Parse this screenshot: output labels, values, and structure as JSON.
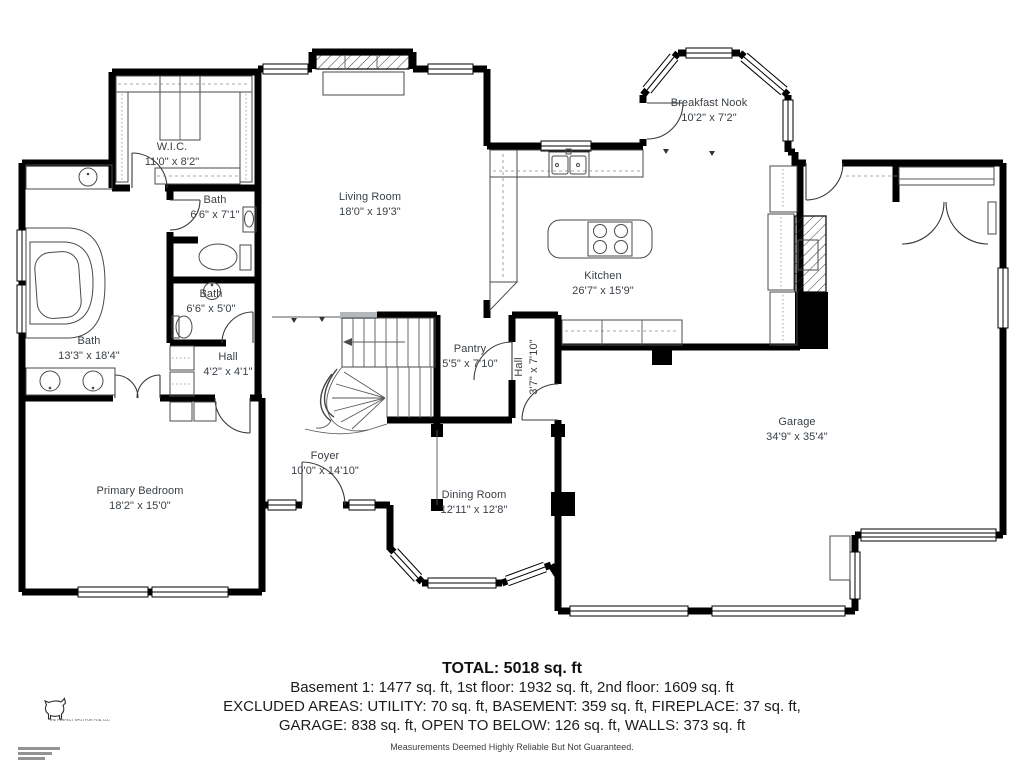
{
  "rooms": [
    {
      "id": "wic",
      "name": "W.I.C.",
      "dims": "11'0\" x 8'2\""
    },
    {
      "id": "bath-upper",
      "name": "Bath",
      "dims": "6'6\" x 7'1\""
    },
    {
      "id": "living-room",
      "name": "Living Room",
      "dims": "18'0\" x 19'3\""
    },
    {
      "id": "breakfast-nook",
      "name": "Breakfast Nook",
      "dims": "10'2\" x 7'2\""
    },
    {
      "id": "kitchen",
      "name": "Kitchen",
      "dims": "26'7\" x 15'9\""
    },
    {
      "id": "bath-middle",
      "name": "Bath",
      "dims": "6'6\" x 5'0\""
    },
    {
      "id": "bath-primary",
      "name": "Bath",
      "dims": "13'3\" x 18'4\""
    },
    {
      "id": "hall-small",
      "name": "Hall",
      "dims": "4'2\" x 4'1\""
    },
    {
      "id": "pantry",
      "name": "Pantry",
      "dims": "5'5\" x 7'10\""
    },
    {
      "id": "hall-vertical",
      "name": "Hall",
      "dims": "3'7\" x 7'10\""
    },
    {
      "id": "garage",
      "name": "Garage",
      "dims": "34'9\" x 35'4\""
    },
    {
      "id": "primary-bedroom",
      "name": "Primary Bedroom",
      "dims": "18'2\" x 15'0\""
    },
    {
      "id": "foyer",
      "name": "Foyer",
      "dims": "10'0\" x 14'10\""
    },
    {
      "id": "dining-room",
      "name": "Dining Room",
      "dims": "12'11\" x 12'8\""
    }
  ],
  "footer": {
    "total": "TOTAL: 5018 sq. ft",
    "floors": "Basement 1: 1477 sq. ft, 1st floor: 1932 sq. ft, 2nd floor: 1609 sq. ft",
    "excluded_line1": "EXCLUDED AREAS: UTILITY: 70 sq. ft, BASEMENT: 359 sq. ft, FIREPLACE: 37 sq. ft,",
    "excluded_line2": "GARAGE: 838 sq. ft, OPEN TO BELOW: 126 sq. ft, WALLS: 373 sq. ft",
    "disclaimer": "Measurements Deemed Highly Reliable But Not Guaranteed."
  },
  "logo": {
    "company": "THE PERFECT SPOT FOR YOU, LLC"
  },
  "colors": {
    "walls": "#000000",
    "room_label_text": "#3a4046",
    "footer_text": "#1d1d1d",
    "disclaimer_text": "#3f3f3f",
    "background": "#ffffff"
  }
}
